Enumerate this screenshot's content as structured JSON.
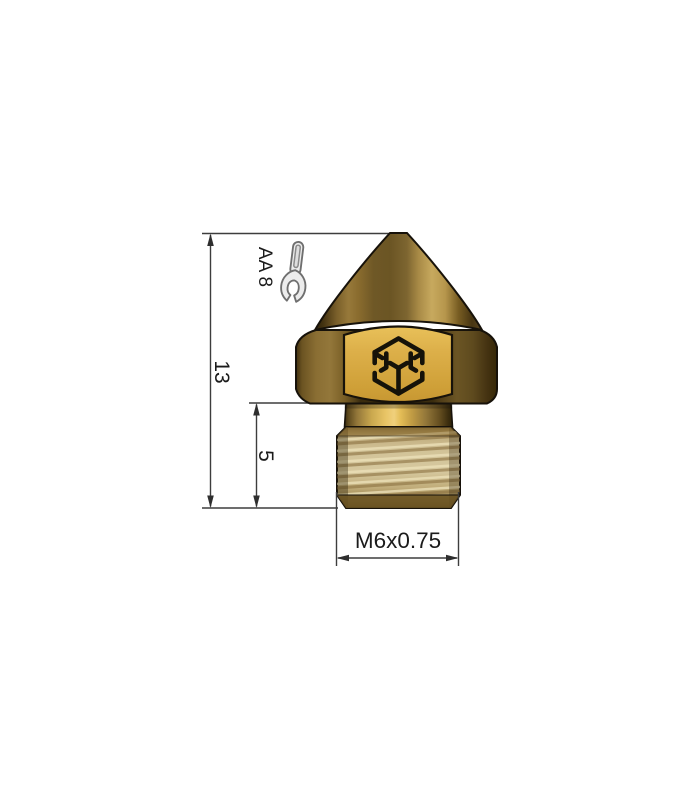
{
  "drawing": {
    "annotations": {
      "overall_height_mm": "13",
      "thread_length_mm": "5",
      "thread_spec": "M6x0.75",
      "wrench_size": "AA 8"
    },
    "icons": {
      "wrench": "wrench-icon",
      "logo": "hex-cube-logo-icon"
    },
    "colors": {
      "background": "#ffffff",
      "dimension_lines": "#3d3d3d",
      "annotation_text": "#1b1b1b",
      "part_outline": "#17120a",
      "brass_bright": "#e8c465",
      "brass_face": "#d9ac41",
      "brass_mid": "#8a6e33",
      "brass_dark": "#3a2c0e",
      "thread_tan": "#d2c398",
      "logo_ink": "#151209",
      "wrench_fill": "#ececec",
      "wrench_outline": "#6f6f6f"
    }
  }
}
